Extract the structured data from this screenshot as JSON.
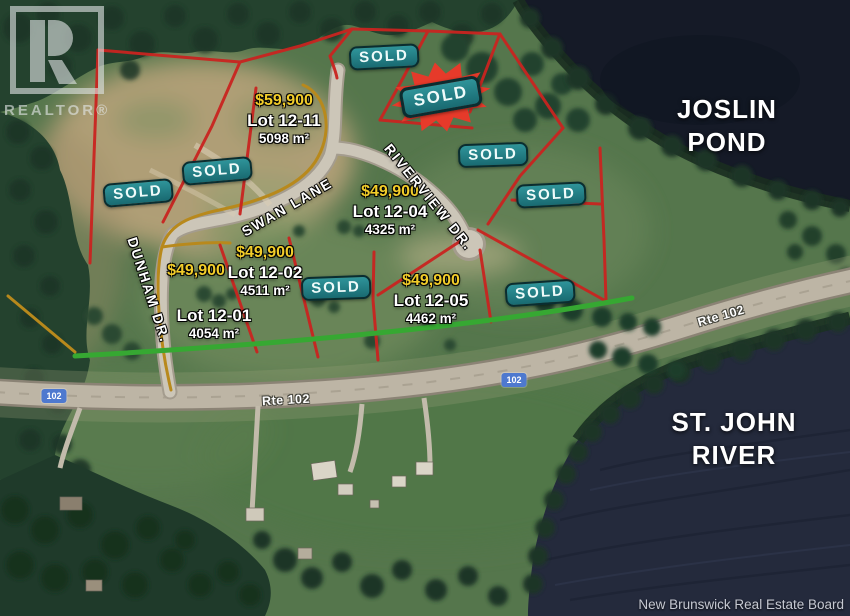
{
  "branding": {
    "logo_letter": "R",
    "logo_wordmark": "REALTOR®"
  },
  "water_labels": {
    "pond": [
      "JOSLIN",
      "POND"
    ],
    "river": [
      "ST. JOHN",
      "RIVER"
    ]
  },
  "sold_markers": [
    "SOLD",
    "SOLD",
    "SOLD",
    "SOLD",
    "SOLD",
    "SOLD",
    "SOLD",
    "SOLD"
  ],
  "lots": [
    {
      "price": "$59,900",
      "name": "Lot 12-11",
      "area": "5098 m²"
    },
    {
      "price": "$49,900",
      "name": "Lot 12-04",
      "area": "4325 m²"
    },
    {
      "price": "$49,900",
      "name": "Lot 12-02",
      "area": "4511 m²"
    },
    {
      "price": "$49,900",
      "name": "Lot 12-01",
      "area": "4054 m²"
    },
    {
      "price": "$49,900",
      "name": "Lot 12-05",
      "area": "4462 m²"
    }
  ],
  "street_labels": {
    "swan_lane": "SWAN LANE",
    "riverview_dr": "RIVERVIEW DR.",
    "dunham_dr": "DUNHAM DR.",
    "rte102_left": "Rte 102",
    "rte102_right": "Rte 102"
  },
  "route_shields": [
    "102",
    "102"
  ],
  "attribution": "New Brunswick Real Estate Board",
  "colors": {
    "sold_badge": "#1f757b",
    "price_yellow": "#f2cd2a",
    "boundary_red": "#c92420",
    "boundary_orange": "#b8891c",
    "frontage_green": "#36a832",
    "water": "#242a3c",
    "shield_blue": "#4e79cf"
  }
}
